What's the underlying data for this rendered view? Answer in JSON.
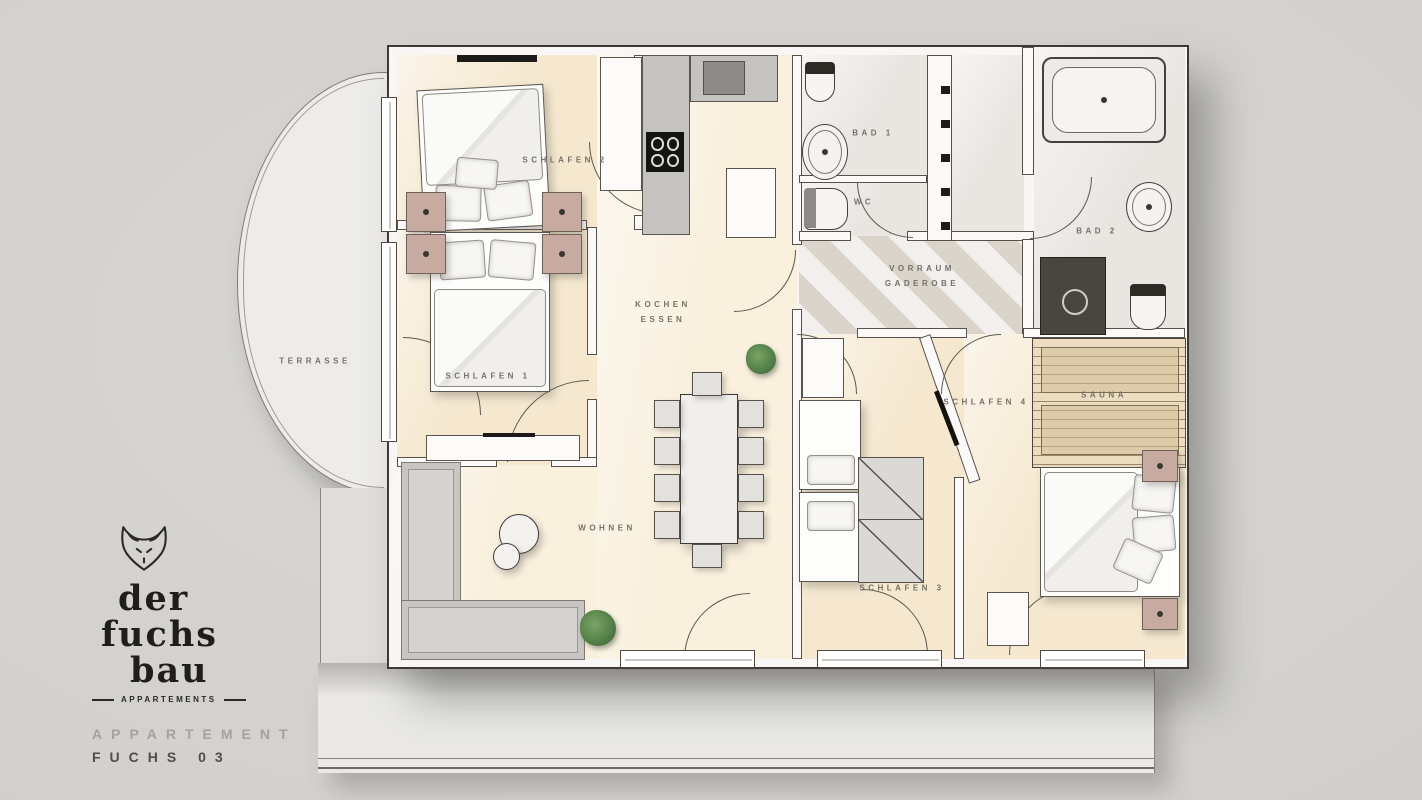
{
  "branding": {
    "logo_word1": "der",
    "logo_word2": "fuchs",
    "logo_word3": "bau",
    "logo_tagline": "APPARTEMENTS",
    "apartment_label": "APPARTEMENT",
    "apartment_name": "FUCHS 03"
  },
  "rooms": {
    "terrasse": {
      "label": "TERRASSE"
    },
    "schlafen1": {
      "label": "SCHLAFEN 1"
    },
    "schlafen2": {
      "label": "SCHLAFEN 2"
    },
    "schlafen3": {
      "label": "SCHLAFEN 3"
    },
    "schlafen4": {
      "label": "SCHLAFEN 4"
    },
    "kochen_essen": {
      "line1": "KOCHEN",
      "line2": "ESSEN"
    },
    "wohnen": {
      "label": "WOHNEN"
    },
    "bad1": {
      "label": "BAD 1"
    },
    "bad2": {
      "label": "BAD 2"
    },
    "wc": {
      "label": "WC"
    },
    "vorraum": {
      "line1": "VORRAUM",
      "line2": "GADEROBE"
    },
    "sauna": {
      "label": "SAUNA"
    }
  },
  "colors": {
    "background": "#d3d1ce",
    "floor_cream": "#f5e8cf",
    "floor_light_gray": "#e9e6e2",
    "wall_white": "#f8f7f5",
    "outline": "#56524b",
    "nightstand_wood": "#c7aba0",
    "sofa_gray": "#c8c6c3",
    "plant_green": "#55814a",
    "sauna_wood": "#ecddc0"
  }
}
